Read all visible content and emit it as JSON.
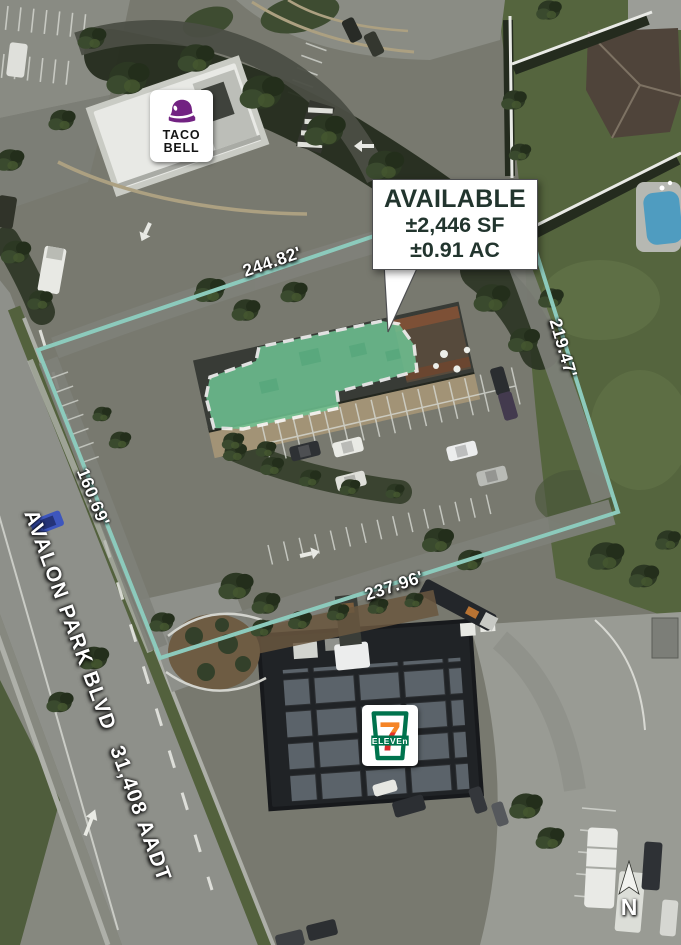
{
  "parcel": {
    "callout": {
      "line1": "AVAILABLE",
      "line2": "±2,446 SF",
      "line3": "±0.91 AC"
    },
    "dimensions": {
      "top": "244.82'",
      "right": "219.47'",
      "bottom": "237.96'",
      "left": "160.69'"
    },
    "road": {
      "name": "AVALON PARK BLVD",
      "traffic": "31,408 AADT"
    },
    "north": "N",
    "tenants": {
      "taco_bell": {
        "line1": "TACO",
        "line2": "BELL"
      },
      "seven_eleven": {
        "digit": "7",
        "word": "ELEVEn"
      }
    },
    "colors": {
      "boundary_teal": "#8ccabc",
      "overlay_green": "#6fc493",
      "overlay_dash": "#ffffff",
      "callout_text": "#22352e",
      "label_white": "#ffffff",
      "taco_bell_purple": "#722282",
      "seven_eleven_green": "#00734d",
      "seven_eleven_red": "#e8302a",
      "seven_eleven_orange": "#f58426"
    }
  }
}
